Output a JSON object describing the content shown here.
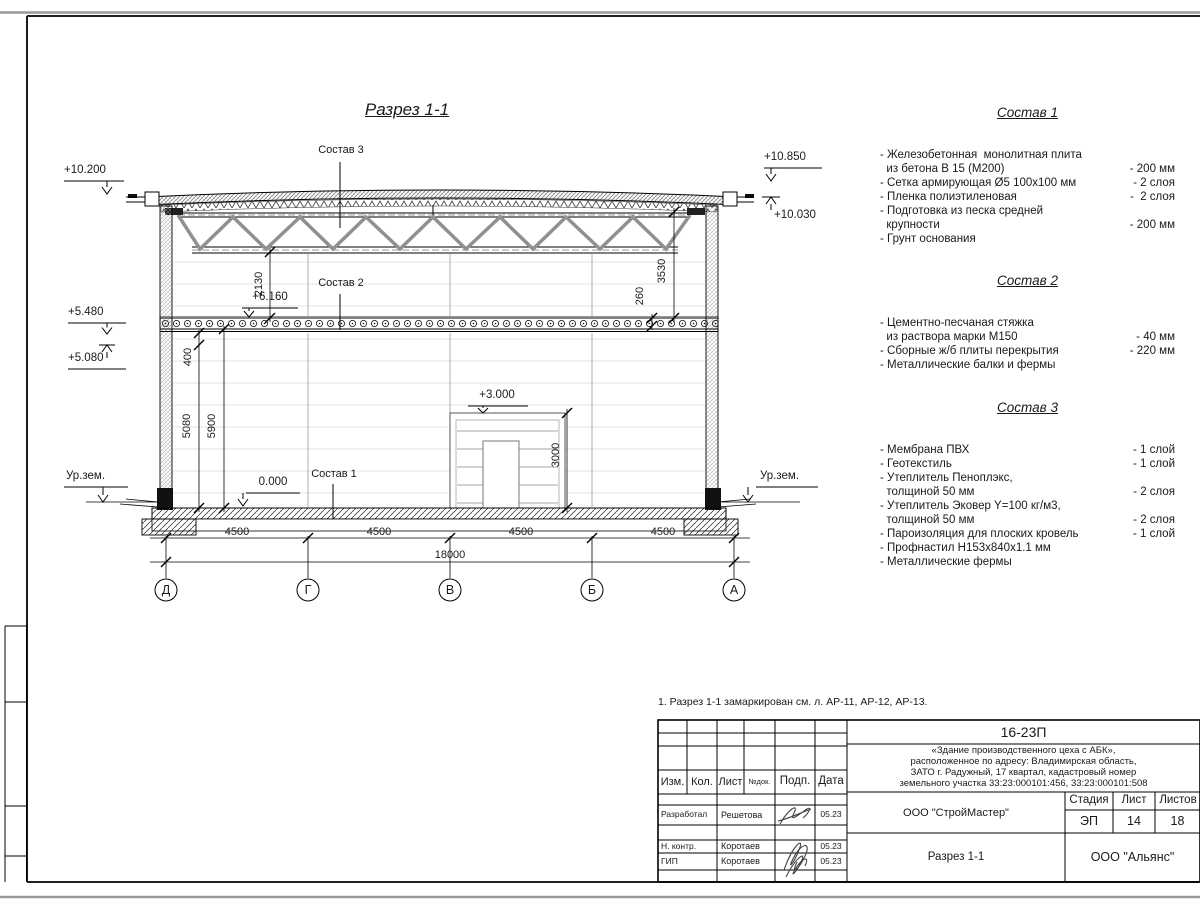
{
  "sheet": {
    "title": "Разрез 1-1",
    "note": "1. Разрез 1-1 замаркирован см. л. АР-11, АР-12, АР-13."
  },
  "drawing": {
    "refs": {
      "s1": "Состав 1",
      "s2": "Состав 2",
      "s3": "Состав 3"
    },
    "elevations": {
      "left_top": "+10.200",
      "left_a": "+5.480",
      "left_b": "+5.080",
      "ground_left": "Ур.зем.",
      "ground_right": "Ур.зем.",
      "right_top": "+10.850",
      "right_a": "+10.030",
      "slab": "+6.160",
      "zero": "0.000",
      "door": "+3.000"
    },
    "dims": {
      "v2130": "2130",
      "v400": "400",
      "v5080": "5080",
      "v5900": "5900",
      "v3530": "3530",
      "v260": "260",
      "v3000": "3000",
      "bay1": "4500",
      "bay2": "4500",
      "bay3": "4500",
      "bay4": "4500",
      "total": "18000"
    },
    "axes": {
      "a1": "Д",
      "a2": "Г",
      "a3": "В",
      "a4": "Б",
      "a5": "А"
    }
  },
  "compositions": [
    {
      "title": "Состав 1",
      "items": [
        {
          "text": "- Железобетонная  монолитная плита\n  из бетона В 15 (М200)",
          "value": "- 200 мм"
        },
        {
          "text": "- Сетка армирующая Ø5 100х100 мм",
          "value": "- 2 слоя"
        },
        {
          "text": "- Пленка полиэтиленовая",
          "value": "-  2 слоя"
        },
        {
          "text": "- Подготовка из песка средней\n  крупности",
          "value": "- 200 мм"
        },
        {
          "text": "- Грунт основания",
          "value": ""
        }
      ]
    },
    {
      "title": "Состав 2",
      "items": [
        {
          "text": "- Цементно-песчаная стяжка\n  из раствора марки М150",
          "value": "- 40 мм"
        },
        {
          "text": "- Сборные ж/б плиты перекрытия",
          "value": "- 220 мм"
        },
        {
          "text": "- Металлические балки и фермы",
          "value": ""
        }
      ]
    },
    {
      "title": "Состав 3",
      "items": [
        {
          "text": "- Мембрана ПВХ",
          "value": "- 1 слой"
        },
        {
          "text": "- Геотекстиль",
          "value": "- 1 слой"
        },
        {
          "text": "- Утеплитель Пеноплэкс,\n  толщиной 50 мм",
          "value": "- 2 слоя"
        },
        {
          "text": "- Утеплитель Эковер Y=100 кг/м3,\n  толщиной 50 мм",
          "value": "- 2 слоя"
        },
        {
          "text": "- Пароизоляция для плоских кровель",
          "value": "- 1 слой"
        },
        {
          "text": "- Профнастил Н153х840х1.1 мм",
          "value": ""
        },
        {
          "text": "- Металлические фермы",
          "value": ""
        }
      ]
    }
  ],
  "titleblock": {
    "doc_number": "16-23П",
    "description": "«Здание производственного цеха с АБК»,\nрасположенное по адресу: Владимирская область,\nЗАТО г. Радужный, 17 квартал, кадастровый номер\nземельного участка 33:23:000101:456, 33:23:000101:508",
    "headers": {
      "izm": "Изм.",
      "kol": "Кол.",
      "list": "Лист",
      "ndok": "№док.",
      "podp": "Подп.",
      "data": "Дата",
      "stadia": "Стадия",
      "list2": "Лист",
      "listov": "Листов"
    },
    "rows": [
      {
        "role": "Разработал",
        "name": "Решетова",
        "date": "05.23"
      },
      {
        "role": "Н. контр.",
        "name": "Коротаев",
        "date": "05.23"
      },
      {
        "role": "ГИП",
        "name": "Коротаев",
        "date": "05.23"
      }
    ],
    "org": "ООО \"СтройМастер\"",
    "stage": "ЭП",
    "sheet_no": "14",
    "sheets_total": "18",
    "drawing_name": "Разрез 1-1",
    "company": "ООО \"Альянс\""
  }
}
